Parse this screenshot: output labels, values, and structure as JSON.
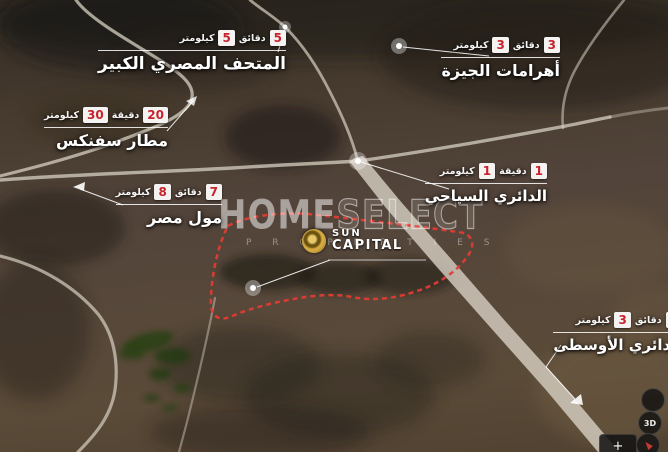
{
  "page": {
    "title": "Sun Capital location map"
  },
  "watermark": {
    "brand_solid": "HOME",
    "brand_outline": "SELECT",
    "subtitle": "P R O P E R T I E S"
  },
  "logo": {
    "line1": "SUN",
    "line2": "CAPITAL"
  },
  "labels": [
    {
      "name": "المتحف المصري الكبير",
      "minutes": "5",
      "minutes_unit": "دقائق",
      "km": "5",
      "km_unit": "كيلومتر"
    },
    {
      "name": "أهرامات الجيزة",
      "minutes": "3",
      "minutes_unit": "دقائق",
      "km": "3",
      "km_unit": "كيلومتر"
    },
    {
      "name": "مطار سفنكس",
      "minutes": "20",
      "minutes_unit": "دقيقة",
      "km": "30",
      "km_unit": "كيلومتر"
    },
    {
      "name": "مول مصر",
      "minutes": "7",
      "minutes_unit": "دقائق",
      "km": "8",
      "km_unit": "كيلومتر"
    },
    {
      "name": "الدائري السياحي",
      "minutes": "1",
      "minutes_unit": "دقيقة",
      "km": "1",
      "km_unit": "كيلومتر"
    },
    {
      "name": "الدائري الأوسطى",
      "minutes": "3",
      "minutes_unit": "دقائق",
      "km": "3",
      "km_unit": "كيلومتر"
    }
  ],
  "controls": {
    "view_3d": "3D",
    "zoom_in": "+"
  },
  "colors": {
    "badge_bg": "#f4f3f1",
    "badge_text": "#c8232c",
    "boundary_red": "#e23c33",
    "road": "#d7d0c2",
    "label_text": "#ffffff"
  }
}
